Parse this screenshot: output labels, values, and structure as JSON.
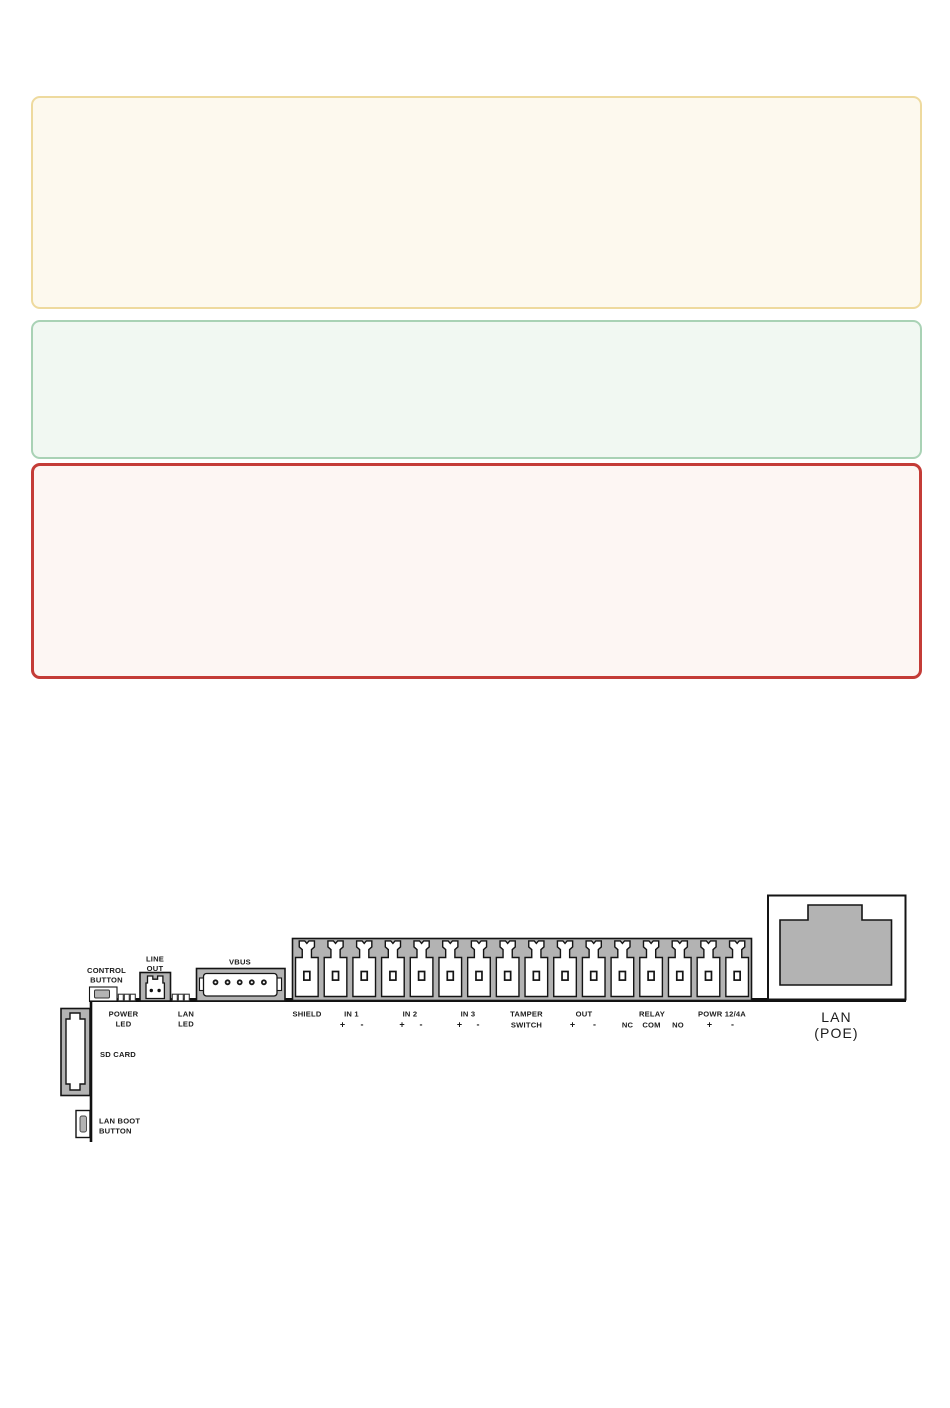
{
  "colors": {
    "yellow_border": "#eeda9e",
    "yellow_bg": "#fdf9ee",
    "green_border": "#a9d2b5",
    "green_bg": "#f1f8f2",
    "red_border": "#c43c37",
    "red_bg": "#fdf6f3",
    "connector_gray": "#b3b3b3",
    "outline_black": "#141414"
  },
  "callouts": [
    {
      "name": "note-yellow",
      "text": ""
    },
    {
      "name": "note-green",
      "text": ""
    },
    {
      "name": "note-red",
      "text": ""
    }
  ],
  "diagram": {
    "terminal_count": 16,
    "vbus_pin_count": 5,
    "labels": {
      "control_button_line1": "CONTROL",
      "control_button_line2": "BUTTON",
      "line_out_line1": "LINE",
      "line_out_line2": "OUT",
      "vbus": "VBUS",
      "power_led_line1": "POWER",
      "power_led_line2": "LED",
      "lan_led_line1": "LAN",
      "lan_led_line2": "LED",
      "sd_card": "SD CARD",
      "lan_boot_line1": "LAN BOOT",
      "lan_boot_line2": "BUTTON",
      "shield": "SHIELD",
      "in1": "IN 1",
      "in2": "IN 2",
      "in3": "IN 3",
      "tamper_line1": "TAMPER",
      "tamper_line2": "SWITCH",
      "out": "OUT",
      "relay": "RELAY",
      "nc": "NC",
      "com": "COM",
      "no": "NO",
      "powr": "POWR 12/4A",
      "plus": "+",
      "minus": "-",
      "lan_line1": "LAN",
      "lan_line2": "(POE)"
    }
  }
}
